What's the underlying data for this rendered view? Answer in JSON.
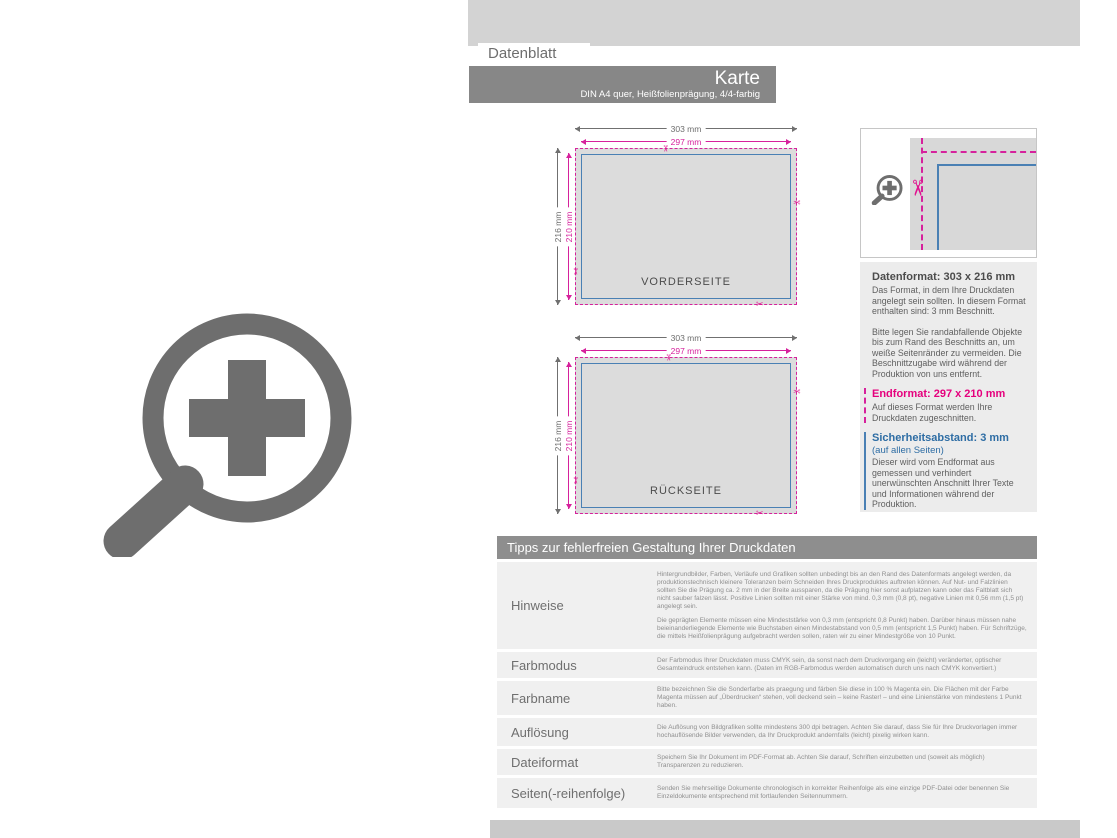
{
  "header": {
    "datenblatt_label": "Datenblatt",
    "title": "Karte",
    "subtitle": "DIN A4 quer, Heißfolienprägung, 4/4-farbig"
  },
  "diagrams": {
    "front": {
      "label": "VORDERSEITE",
      "outer_width": "303 mm",
      "inner_width": "297 mm",
      "outer_height": "216 mm",
      "inner_height": "210 mm"
    },
    "back": {
      "label": "RÜCKSEITE",
      "outer_width": "303 mm",
      "inner_width": "297 mm",
      "outer_height": "216 mm",
      "inner_height": "210 mm"
    }
  },
  "info_panel": {
    "datenformat_title": "Datenformat: 303 x 216 mm",
    "datenformat_text": "Das Format, in dem Ihre Druckdaten angelegt sein sollten. In diesem Format enthalten sind: 3 mm Beschnitt.",
    "bleed_text": "Bitte legen Sie randabfallende Objekte bis zum Rand des Beschnitts an, um weiße Seitenränder zu vermeiden. Die Beschnittzugabe wird während der Produktion von uns entfernt.",
    "endformat_title": "Endformat: 297 x 210 mm",
    "endformat_text": "Auf dieses Format werden Ihre Druckdaten zugeschnitten.",
    "safety_title": "Sicherheitsabstand: 3 mm",
    "safety_sub": "(auf allen Seiten)",
    "safety_text": "Dieser wird vom Endformat aus gemessen und verhindert unerwünschten Anschnitt Ihrer Texte und Informationen während der Produktion."
  },
  "tips": {
    "title": "Tipps zur fehlerfreien Gestaltung Ihrer Druckdaten",
    "rows": [
      {
        "label": "Hinweise",
        "p1": "Hintergrundbilder, Farben, Verläufe und Grafiken sollten unbedingt bis an den Rand des Datenformats angelegt werden, da produktionstechnisch kleinere Toleranzen beim Schneiden Ihres Druckproduktes auftreten können. Auf Nut- und Falzlinien sollten Sie die Prägung ca. 2 mm in der Breite aussparen, da die Prägung hier sonst aufplatzen kann oder das Faltblatt sich nicht sauber falzen lässt. Positive Linien sollten mit einer Stärke von mind. 0,3 mm (0,8 pt), negative Linien mit 0,56 mm (1,5 pt) angelegt sein.",
        "p2": "Die geprägten Elemente müssen eine Mindeststärke von 0,3 mm (entspricht 0,8 Punkt) haben. Darüber hinaus müssen nahe beieinanderliegende Elemente wie Buchstaben einen Mindestabstand von 0,5 mm (entspricht 1,5 Punkt) haben. Für Schriftzüge, die mittels Heißfolienprägung aufgebracht werden sollen, raten wir zu einer Mindestgröße von 10 Punkt."
      },
      {
        "label": "Farbmodus",
        "p1": "Der Farbmodus Ihrer Druckdaten muss CMYK sein, da sonst nach dem Druckvorgang ein (leicht) veränderter, optischer Gesamteindruck entstehen kann. (Daten im RGB-Farbmodus werden automatisch durch uns nach CMYK konvertiert.)"
      },
      {
        "label": "Farbname",
        "p1": "Bitte bezeichnen Sie die Sonderfarbe als praegung und färben Sie diese in 100 % Magenta ein. Die Flächen mit der Farbe Magenta müssen auf „Überdrucken“ stehen, voll deckend sein – keine Raster! – und eine Linienstärke von mindestens 1 Punkt haben."
      },
      {
        "label": "Auflösung",
        "p1": "Die Auflösung von Bildgrafiken sollte mindestens 300 dpi betragen. Achten Sie darauf, dass Sie für Ihre Druckvorlagen immer hochauflösende Bilder verwenden, da Ihr Druckprodukt andernfalls (leicht) pixelig wirken kann."
      },
      {
        "label": "Dateiformat",
        "p1": "Speichern Sie Ihr Dokument im PDF-Format ab. Achten Sie darauf, Schriften einzubetten und (soweit als möglich) Transparenzen zu reduzieren."
      },
      {
        "label": "Seiten(-reihenfolge)",
        "p1": "Senden Sie mehrseitige Dokumente chronologisch in korrekter Reihenfolge als eine einzige PDF-Datei oder benennen Sie Einzeldokumente entsprechend mit fortlaufenden Seitennummern."
      }
    ]
  },
  "icons": {
    "big_zoom": "zoom-plus-icon",
    "small_zoom": "zoom-plus-icon",
    "scissors": "scissors-icon"
  },
  "colors": {
    "magenta": "#d6219c",
    "magenta_bright": "#e5007d",
    "blue": "#4a80b4",
    "blue_heading": "#2e6da4",
    "bar_gray": "#878787",
    "band_gray": "#d3d3d3",
    "row_gray": "#f0f0f0",
    "footer_gray": "#c9c9c9",
    "card_gray": "#dcdcdc",
    "icon_gray": "#6e6e6e"
  }
}
